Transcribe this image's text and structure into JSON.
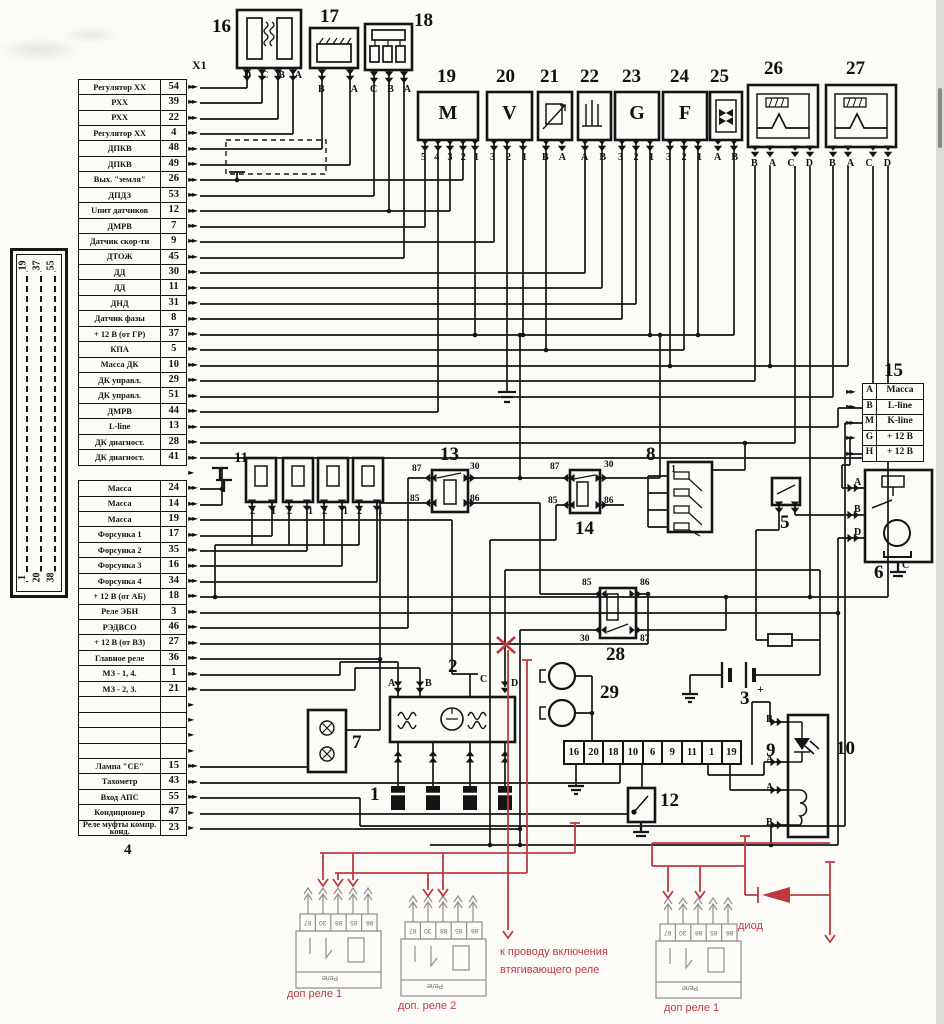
{
  "ecu": {
    "connector_label": "X1",
    "block_label": "4",
    "rows": [
      {
        "l": "Регулятор XX",
        "p": "54",
        "a": "►►"
      },
      {
        "l": "РХХ",
        "p": "39",
        "a": "►►"
      },
      {
        "l": "РХХ",
        "p": "22",
        "a": "►►"
      },
      {
        "l": "Регулятор XX",
        "p": "4",
        "a": "►►"
      },
      {
        "l": "ДПКВ",
        "p": "48",
        "a": "►►"
      },
      {
        "l": "ДПКВ",
        "p": "49",
        "a": "►►"
      },
      {
        "l": "Вых. \"земля\"",
        "p": "26",
        "a": "►►"
      },
      {
        "l": "ДПДЗ",
        "p": "53",
        "a": "►►"
      },
      {
        "l": "Uпит датчиков",
        "p": "12",
        "a": "►►"
      },
      {
        "l": "ДМРВ",
        "p": "7",
        "a": "►►"
      },
      {
        "l": "Датчик скор-ти",
        "p": "9",
        "a": "►►"
      },
      {
        "l": "ДТОЖ",
        "p": "45",
        "a": "►►"
      },
      {
        "l": "ДД",
        "p": "30",
        "a": "►►"
      },
      {
        "l": "ДД",
        "p": "11",
        "a": "►►"
      },
      {
        "l": "ДНД",
        "p": "31",
        "a": "►►"
      },
      {
        "l": "Датчик фазы",
        "p": "8",
        "a": "►►"
      },
      {
        "l": "+ 12 В (от ГР)",
        "p": "37",
        "a": "►►"
      },
      {
        "l": "КПА",
        "p": "5",
        "a": "►►"
      },
      {
        "l": "Масса ДК",
        "p": "10",
        "a": "►►"
      },
      {
        "l": "ДК управл.",
        "p": "29",
        "a": "►►"
      },
      {
        "l": "ДК управл.",
        "p": "51",
        "a": "►►"
      },
      {
        "l": "ДМРВ",
        "p": "44",
        "a": "►►"
      },
      {
        "l": "L-line",
        "p": "13",
        "a": "►►"
      },
      {
        "l": "ДК диагност.",
        "p": "28",
        "a": "►►"
      },
      {
        "l": "ДК диагност.",
        "p": "41",
        "a": "►►"
      },
      {
        "l": "",
        "p": "",
        "a": "►",
        "gap": true
      },
      {
        "l": "Масса",
        "p": "24",
        "a": "►►"
      },
      {
        "l": "Масса",
        "p": "14",
        "a": "►►"
      },
      {
        "l": "Масса",
        "p": "19",
        "a": "►►"
      },
      {
        "l": "Форсунка 1",
        "p": "17",
        "a": "►►"
      },
      {
        "l": "Форсунка 2",
        "p": "35",
        "a": "►►"
      },
      {
        "l": "Форсунка 3",
        "p": "16",
        "a": "►►"
      },
      {
        "l": "Форсунка 4",
        "p": "34",
        "a": "►►"
      },
      {
        "l": "+ 12 В (от АБ)",
        "p": "18",
        "a": "►►"
      },
      {
        "l": "Реле ЭБН",
        "p": "3",
        "a": "►►"
      },
      {
        "l": "РЭДВСО",
        "p": "46",
        "a": "►►"
      },
      {
        "l": "+ 12 В (от ВЗ)",
        "p": "27",
        "a": "►►"
      },
      {
        "l": "Главное реле",
        "p": "36",
        "a": "►►"
      },
      {
        "l": "МЗ - 1, 4.",
        "p": "1",
        "a": "►►"
      },
      {
        "l": "МЗ - 2, 3.",
        "p": "21",
        "a": "►►"
      },
      {
        "l": "",
        "p": "",
        "a": "►"
      },
      {
        "l": "",
        "p": "",
        "a": "►"
      },
      {
        "l": "",
        "p": "",
        "a": "►"
      },
      {
        "l": "",
        "p": "",
        "a": "►"
      },
      {
        "l": "Лампа \"СЕ\"",
        "p": "15",
        "a": "►►"
      },
      {
        "l": "Тахометр",
        "p": "43",
        "a": "►►"
      },
      {
        "l": "Вход АПС",
        "p": "55",
        "a": "►►"
      },
      {
        "l": "Кондиционер",
        "p": "47",
        "a": "►"
      },
      {
        "l": "Реле муфты компр. конд.",
        "p": "23",
        "a": "►"
      }
    ]
  },
  "left_connector": {
    "cols": [
      {
        "t": "19",
        "b": "1"
      },
      {
        "t": "37",
        "b": "20"
      },
      {
        "t": "55",
        "b": "38"
      }
    ]
  },
  "block15": {
    "num": "15",
    "rows": [
      {
        "a": "►►",
        "p": "A",
        "l": "Масса"
      },
      {
        "a": "►►",
        "p": "B",
        "l": "L-line"
      },
      {
        "a": "►►",
        "p": "M",
        "l": "K-line"
      },
      {
        "a": "►►",
        "p": "G",
        "l": "+ 12 В"
      },
      {
        "a": "►►",
        "p": "H",
        "l": "+ 12 В"
      }
    ]
  },
  "connector9": {
    "num": "9",
    "cells": [
      "16",
      "20",
      "18",
      "10",
      "6",
      "9",
      "11",
      "1",
      "19"
    ]
  },
  "components": {
    "c1": {
      "num": "1"
    },
    "c2": {
      "num": "2",
      "pins": [
        "A",
        "B",
        "C",
        "D"
      ]
    },
    "c3": {
      "num": "3",
      "plus": "+"
    },
    "c5": {
      "num": "5"
    },
    "c6": {
      "num": "6",
      "pins": [
        "A",
        "B",
        "D",
        "C"
      ]
    },
    "c7": {
      "num": "7"
    },
    "c8": {
      "num": "8",
      "tag": "1"
    },
    "c10": {
      "num": "10",
      "pins": [
        "B",
        "A",
        "A",
        "B"
      ]
    },
    "c11": {
      "num": "11"
    },
    "c12": {
      "num": "12"
    },
    "c13": {
      "num": "13",
      "tl": "87",
      "tr": "30",
      "bl": "85",
      "br": "86"
    },
    "c14": {
      "num": "14",
      "tl": "87",
      "tr": "30",
      "bl": "85",
      "br": "86"
    },
    "c16": {
      "num": "16",
      "pins": [
        "D",
        "C",
        "B",
        "A"
      ]
    },
    "c17": {
      "num": "17",
      "pins": [
        "B",
        "A"
      ]
    },
    "c18": {
      "num": "18",
      "pins": [
        "C",
        "B",
        "A"
      ]
    },
    "c19": {
      "num": "19",
      "letter": "M",
      "pins": [
        "5",
        "4",
        "3",
        "2",
        "1"
      ]
    },
    "c20": {
      "num": "20",
      "letter": "V",
      "pins": [
        "3",
        "2",
        "1"
      ]
    },
    "c21": {
      "num": "21",
      "pins": [
        "B",
        "A"
      ]
    },
    "c22": {
      "num": "22",
      "pins": [
        "A",
        "B"
      ]
    },
    "c23": {
      "num": "23",
      "letter": "G",
      "pins": [
        "3",
        "2",
        "1"
      ]
    },
    "c24": {
      "num": "24",
      "letter": "F",
      "pins": [
        "3",
        "2",
        "1"
      ]
    },
    "c25": {
      "num": "25",
      "pins": [
        "A",
        "B"
      ]
    },
    "c26": {
      "num": "26",
      "pins": [
        "B",
        "A",
        "C",
        "D"
      ]
    },
    "c27": {
      "num": "27",
      "pins": [
        "B",
        "A",
        "C",
        "D"
      ]
    },
    "c28": {
      "num": "28",
      "tl": "85",
      "tr": "86",
      "bl": "30",
      "br": "87"
    },
    "c29": {
      "num": "29"
    }
  },
  "inj": {
    "pair": [
      "2",
      "1"
    ]
  },
  "aux": {
    "pins": [
      "87",
      "30",
      "88",
      "85",
      "86"
    ],
    "body": "Реле"
  },
  "annotations": {
    "relay1": "доп реле 1",
    "relay2": "доп. реле 2",
    "relay3": "доп реле 1",
    "diode": "диод",
    "note_line1": "к проводу включения",
    "note_line2": "втягивающего реле"
  },
  "colors": {
    "ink": "#141414",
    "overlay_red": "#bf3a3e",
    "paper": "#fcfbf8",
    "faded": "#8f8f8f"
  }
}
